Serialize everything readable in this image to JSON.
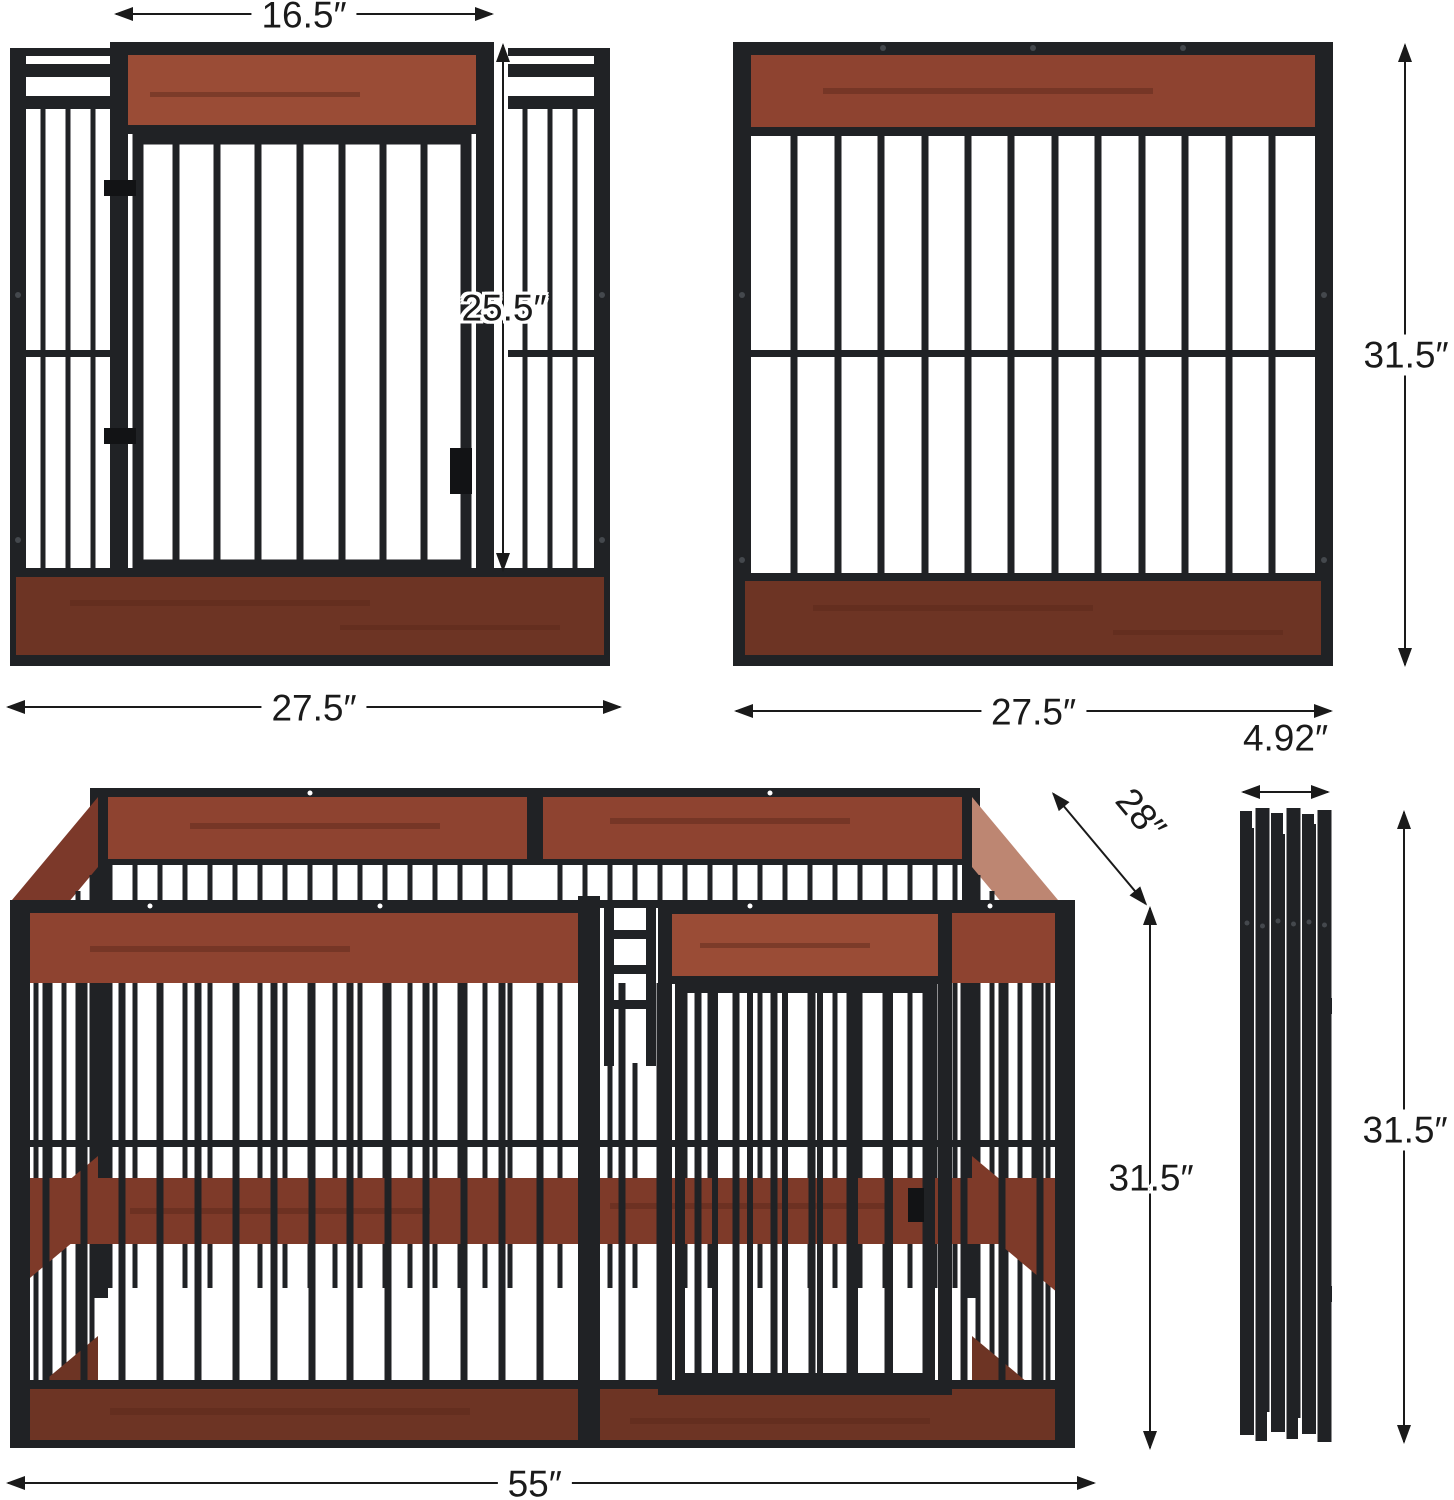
{
  "colors": {
    "metal": "#202225",
    "metal_dark": "#121315",
    "wood_top": "#8e4330",
    "wood_door": "#9a4c36",
    "wood_bottom": "#6d3424",
    "wood_side_light": "#bd8672",
    "wood_side_dark": "#7c392a",
    "wood_mid": "#7e3a29",
    "dim": "#1a1a1a",
    "bg": "#ffffff"
  },
  "dimensions": {
    "front_door_width": {
      "label": "16.5″"
    },
    "front_door_height": {
      "label": "25.5″"
    },
    "front_panel_width": {
      "label": "27.5″"
    },
    "side_panel_height": {
      "label": "31.5″"
    },
    "side_panel_width": {
      "label": "27.5″"
    },
    "pen_depth": {
      "label": "28″"
    },
    "pen_height": {
      "label": "31.5″"
    },
    "pen_width": {
      "label": "55″"
    },
    "folded_thickness": {
      "label": "4.92″"
    },
    "folded_height": {
      "label": "31.5″"
    }
  }
}
